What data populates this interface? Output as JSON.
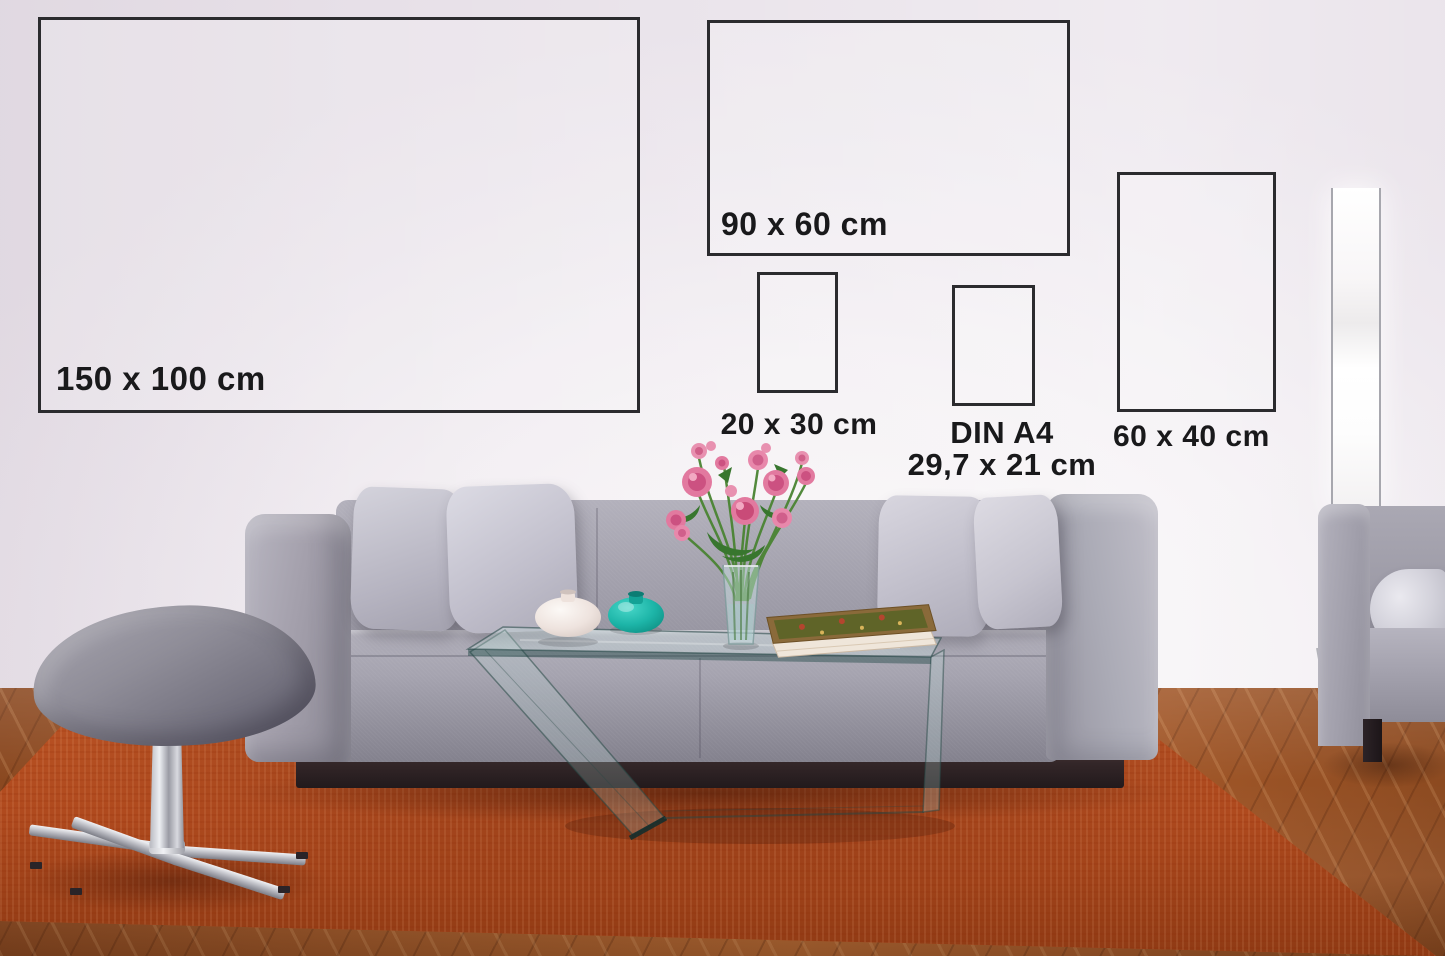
{
  "size_guide": {
    "frames": [
      {
        "size_id": "150x100",
        "label": "150 x 100 cm"
      },
      {
        "size_id": "90x60",
        "label": "90 x 60 cm"
      },
      {
        "size_id": "20x30",
        "label": "20 x 30 cm"
      },
      {
        "size_id": "din-a4",
        "label": "DIN A4",
        "sublabel": "29,7 x 21 cm"
      },
      {
        "size_id": "60x40",
        "label": "60 x 40 cm"
      }
    ],
    "label_color": "#19191b",
    "frame_border_color": "#2b2b2e"
  },
  "scene": {
    "colors": {
      "wall": "#efeaf0",
      "sofa_fabric": "#a3a1ac",
      "pillow_light": "#d6d5de",
      "rug_orange": "#b54d22",
      "floor_wood": "#9c5426",
      "vase_teal": "#1fbdb0",
      "vase_white": "#f3ece8",
      "flower_pink": "#e2799f",
      "leaf_green": "#3c7a33",
      "lamp_white": "#ffffff",
      "chrome": "#c9c9d0",
      "book_cover": "#5f6428"
    }
  }
}
